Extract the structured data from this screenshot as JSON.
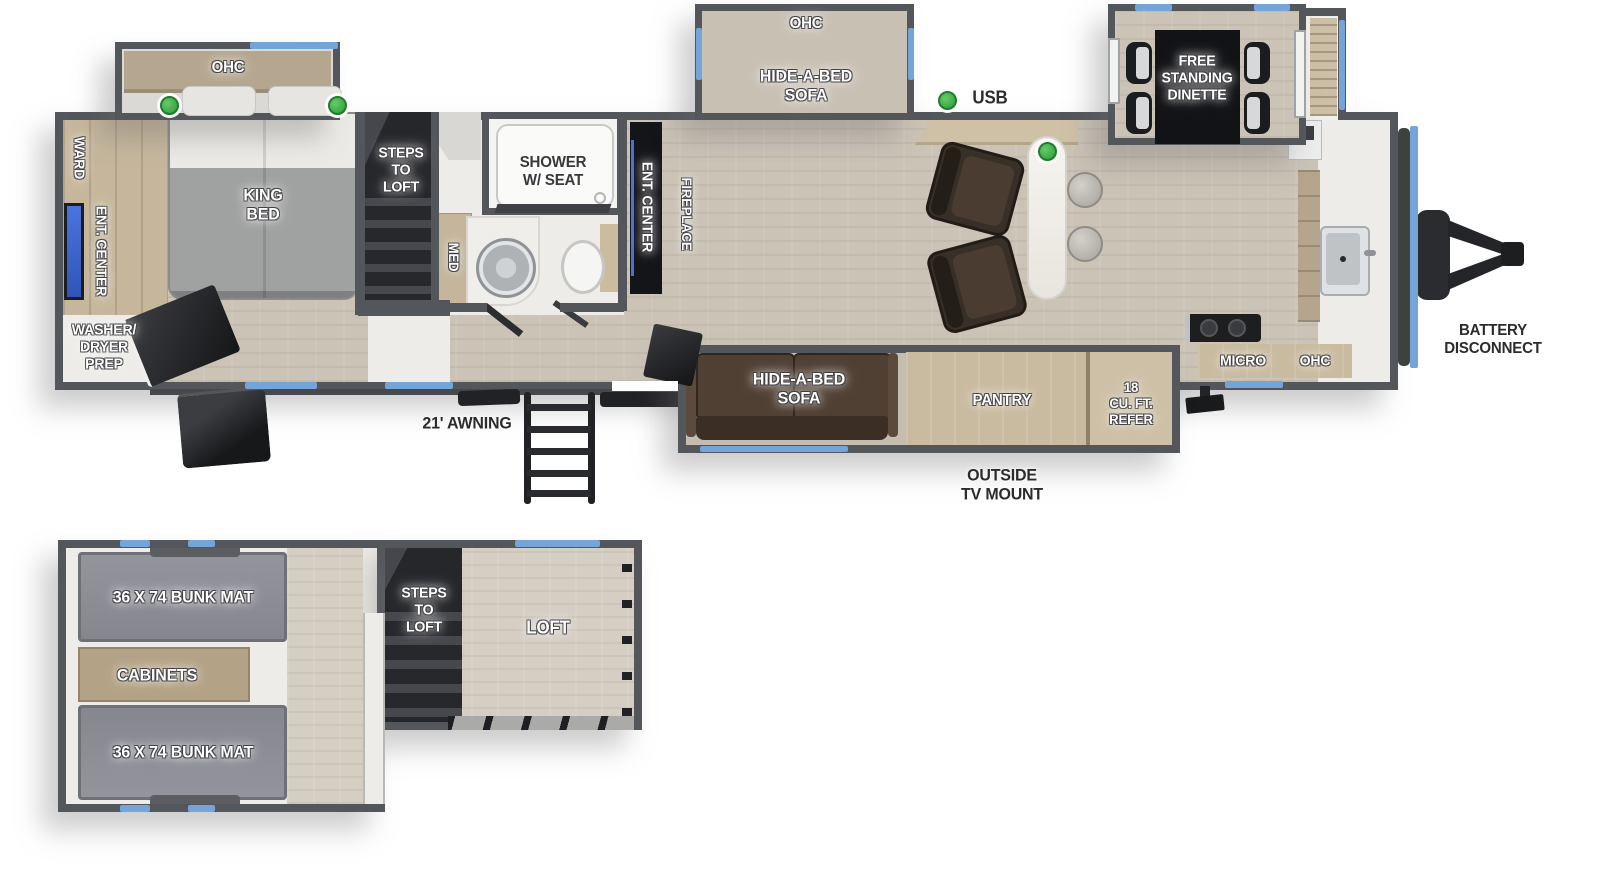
{
  "colors": {
    "wall": "#53565a",
    "window_blue": "#74a4d8",
    "accent_green": "#3fae49",
    "floor_wood": "#cbc3b6",
    "cabinet_tan": "#c9bba0",
    "sofa_brown": "#503f33",
    "label_white": "#ffffff",
    "label_dark": "#2c2c2f"
  },
  "main_floor": {
    "bed_slide": {
      "ohc_label": "OHC"
    },
    "bedroom": {
      "ward_label": "WARD",
      "ent_center_label": "ENT. CENTER",
      "king_bed_label": "KING\nBED",
      "washer_dryer_label": "WASHER/\nDRYER\nPREP"
    },
    "steps_label": "STEPS\nTO\nLOFT",
    "bathroom": {
      "med_label": "MED",
      "shower_label": "SHOWER\nW/ SEAT"
    },
    "living": {
      "ent_center_label": "ENT. CENTER",
      "fireplace_label": "FIREPLACE",
      "sofa_top_ohc_label": "OHC",
      "sofa_top_label": "HIDE-A-BED\nSOFA",
      "sofa_bottom_label": "HIDE-A-BED\nSOFA",
      "usb_label": "USB"
    },
    "dinette": {
      "label": "FREE\nSTANDING\nDINETTE"
    },
    "kitchen": {
      "pantry_label": "PANTRY",
      "refer_label": "18\nCU. FT.\nREFER",
      "micro_label": "MICRO",
      "ohc_label": "OHC"
    },
    "exterior": {
      "awning_label": "21' AWNING",
      "outside_tv_label": "OUTSIDE\nTV MOUNT",
      "battery_label": "BATTERY\nDISCONNECT"
    }
  },
  "loft": {
    "bunk_top_label": "36 X 74 BUNK MAT",
    "bunk_bottom_label": "36 X 74 BUNK MAT",
    "cabinets_label": "CABINETS",
    "steps_label": "STEPS\nTO\nLOFT",
    "loft_label": "LOFT"
  }
}
